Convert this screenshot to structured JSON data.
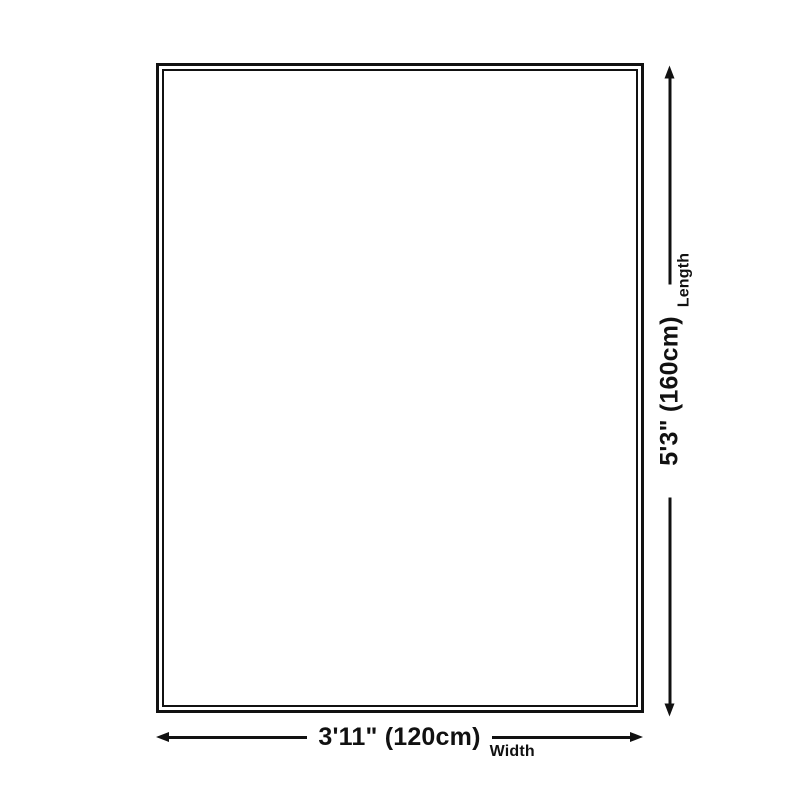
{
  "diagram": {
    "type": "size-dimension-diagram",
    "shape": "rectangle",
    "dimensions": {
      "length": {
        "value": "5'3\" (160cm)",
        "label": "Length"
      },
      "width": {
        "value": "3'11\" (120cm)",
        "label": "Width"
      }
    }
  },
  "icons": {
    "arrowhead_up": "triangle-up",
    "arrowhead_down": "triangle-down",
    "arrowhead_left": "triangle-left",
    "arrowhead_right": "triangle-right"
  },
  "colors": {
    "line": "#111111",
    "background": "#ffffff"
  }
}
